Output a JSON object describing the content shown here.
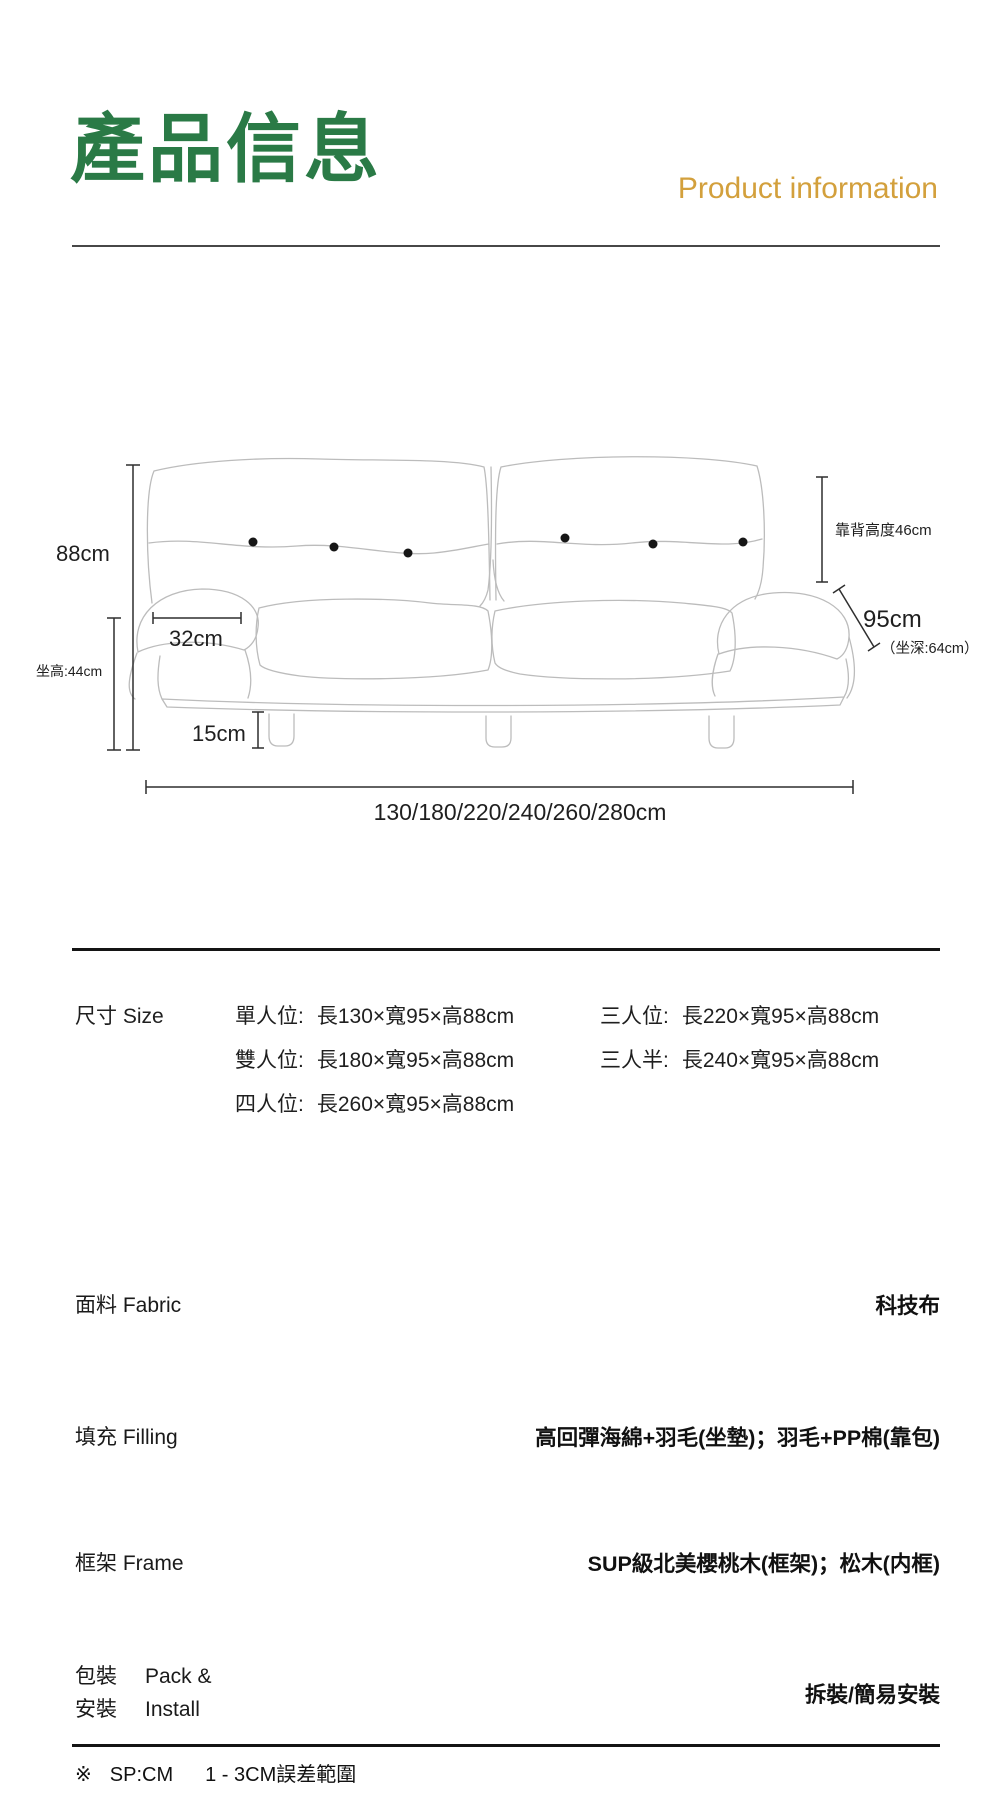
{
  "header": {
    "title_zh": "產品信息",
    "title_en": "Product information"
  },
  "colors": {
    "title_green": "#2a7a46",
    "accent_gold": "#d3a03c",
    "text": "#1a1a1a",
    "line_art": "#bcbcbc"
  },
  "diagram": {
    "total_height": "88cm",
    "seat_height": "坐高:44cm",
    "arm_width": "32cm",
    "leg_height": "15cm",
    "back_height": "靠背高度46cm",
    "depth": "95cm",
    "seat_depth": "（坐深:64cm）",
    "lengths": "130/180/220/240/260/280cm"
  },
  "specs": {
    "size": {
      "label": "尺寸 Size",
      "col1": [
        {
          "name": "單人位:",
          "dims": "長130×寬95×高88cm"
        },
        {
          "name": "雙人位:",
          "dims": "長180×寬95×高88cm"
        },
        {
          "name": "四人位:",
          "dims": "長260×寬95×高88cm"
        }
      ],
      "col2": [
        {
          "name": "三人位:",
          "dims": "長220×寬95×高88cm"
        },
        {
          "name": "三人半:",
          "dims": "長240×寬95×高88cm"
        }
      ]
    },
    "fabric": {
      "label": "面料 Fabric",
      "value": "科技布"
    },
    "filling": {
      "label": "填充 Filling",
      "value": "高回彈海綿+羽毛(坐墊)；羽毛+PP棉(靠包)"
    },
    "frame": {
      "label": "框架 Frame",
      "value": "SUP級北美櫻桃木(框架)；松木(内框)"
    },
    "pack": {
      "label_zh_1": "包裝",
      "label_zh_2": "安裝",
      "label_en_1": "Pack &",
      "label_en_2": "Install",
      "value": "拆裝/簡易安裝"
    }
  },
  "footer": {
    "marker": "※",
    "unit": "SP:CM",
    "tolerance": "1 - 3CM誤差範圍"
  }
}
